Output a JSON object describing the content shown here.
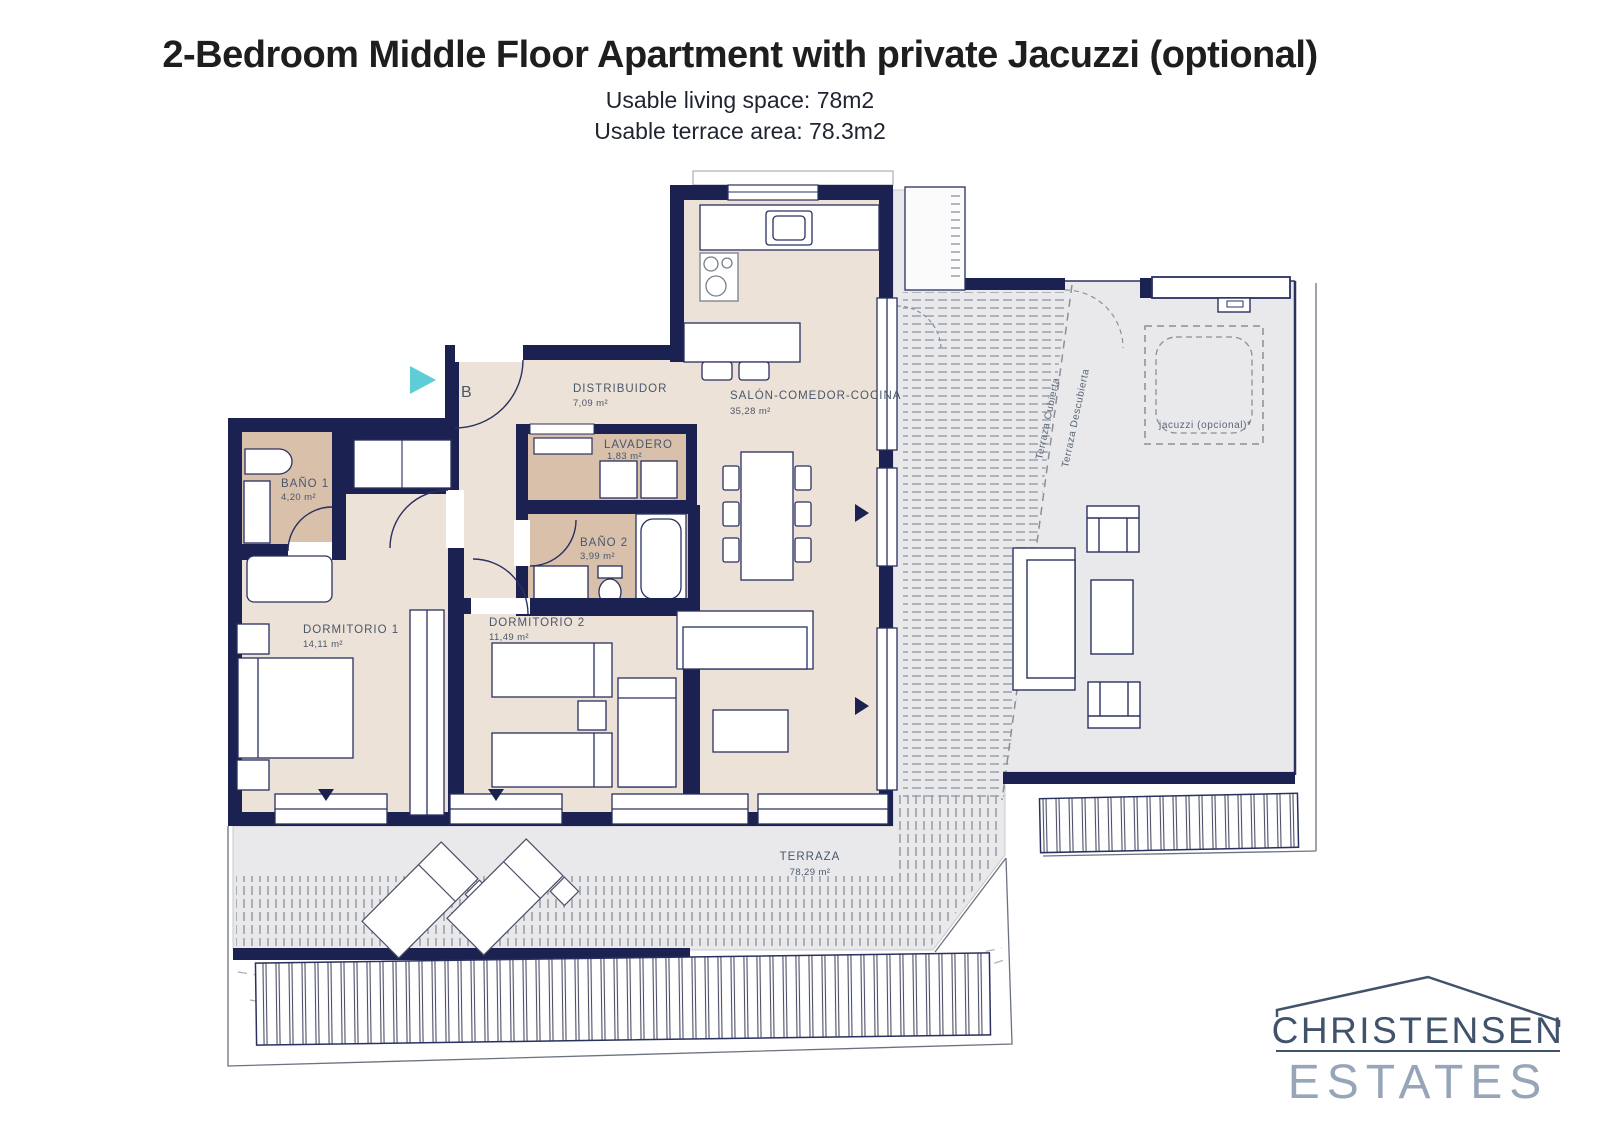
{
  "header": {
    "title": "2-Bedroom Middle Floor Apartment with private Jacuzzi (optional)",
    "subtitle1": "Usable living space: 78m2",
    "subtitle2": "Usable terrace area: 78.3m2"
  },
  "floorplan": {
    "unit_label": "B",
    "rooms": {
      "distribuidor": {
        "name": "DISTRIBUIDOR",
        "area": "7,09 m²"
      },
      "salon": {
        "name": "SALÓN-COMEDOR-COCINA",
        "area": "35,28 m²"
      },
      "lavadero": {
        "name": "LAVADERO",
        "area": "1,83 m²"
      },
      "bano1": {
        "name": "BAÑO 1",
        "area": "4,20 m²"
      },
      "bano2": {
        "name": "BAÑO 2",
        "area": "3,99 m²"
      },
      "dorm1": {
        "name": "DORMITORIO 1",
        "area": "14,11 m²"
      },
      "dorm2": {
        "name": "DORMITORIO 2",
        "area": "11,49 m²"
      },
      "terraza": {
        "name": "TERRAZA",
        "area": "78,29 m²"
      }
    },
    "annotations": {
      "terraza_cubierta": "Terraza Cubierta",
      "terraza_descubierta": "Terraza Descubierta",
      "jacuzzi": "jacuzzi (opcional)*"
    },
    "colors": {
      "wall": "#1b2150",
      "floor": "#ece2d7",
      "wet_floor": "#d8c0ab",
      "terrace": "#e9e9eb",
      "accent_arrow": "#5fcdd5",
      "label": "#4a576b"
    }
  },
  "logo": {
    "line1": "CHRISTENSEN",
    "line2": "ESTATES"
  }
}
